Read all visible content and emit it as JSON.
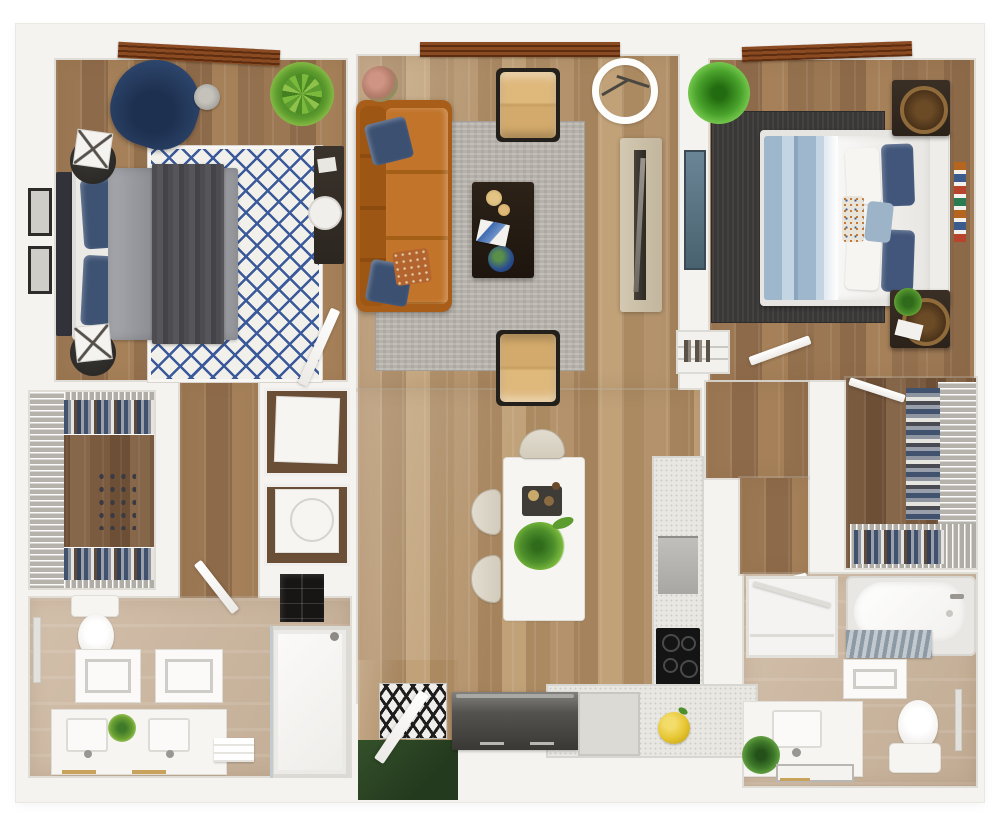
{
  "plan": {
    "label": "3D top-down floor plan of a two-bedroom, two-bathroom apartment with open living, dining and kitchen",
    "view": "3d-render-top-down",
    "canvas_width": "1000",
    "canvas_height": "818"
  },
  "palette": {
    "background": "#ffffff",
    "wall": "#f5f3f0",
    "wood_light": "#bb9c75",
    "wood_medium": "#a07b58",
    "wood_dark_closet": "#7e5f43",
    "bathroom_floor_tan": "#c9b299",
    "living_rug_gray": "#b6b1aa",
    "bedroom1_rug_blue": "#3b5a9b",
    "bedroom2_rug_charcoal": "#3a3836",
    "sofa_orange": "#b3661d",
    "armchair_tan": "#d4aa6c",
    "pillow_navy": "#3e5374",
    "bed2_sheet_blue": "#a9bed2",
    "plant_green": "#5d9c2e",
    "grass_green": "#2c421f",
    "lemon_yellow": "#e6c52f",
    "window_wood_brown": "#8a4a22",
    "counter_speckle": "#e9e7e2",
    "cooktop_black": "#141414"
  },
  "rooms": [
    {
      "id": "bedroom-1",
      "items": [
        "bed-gray-duvet-navy-pillows",
        "blue-diamond-rug",
        "navy-accent-chair",
        "round-side-table",
        "nightstand-lamp-top",
        "nightstand-lamp-bottom",
        "potted-plant",
        "desk-with-chair",
        "wall-frames",
        "wood-blind-window"
      ]
    },
    {
      "id": "living-room",
      "items": [
        "orange-leather-sofa",
        "gray-area-rug",
        "dark-coffee-table",
        "tan-armchair-top",
        "tan-armchair-bottom",
        "arc-floor-lamp",
        "media-console-tv",
        "flower-vase",
        "wood-frame-window"
      ]
    },
    {
      "id": "bedroom-2",
      "items": [
        "bed-white-duvet-blue-sheets",
        "charcoal-rug",
        "nightstand-ring-lamp-top",
        "nightstand-ring-lamp-bottom",
        "potted-plant",
        "wall-art-panel",
        "gallery-strip",
        "wood-blind-window"
      ]
    },
    {
      "id": "walk-in-closet-left",
      "items": [
        "wire-shelving",
        "hanging-clothes"
      ]
    },
    {
      "id": "laundry-closets",
      "items": [
        "dryer",
        "washer",
        "glass-front-cabinet"
      ]
    },
    {
      "id": "bathroom-1",
      "items": [
        "toilet",
        "double-sink-vanity",
        "bath-mat-left",
        "bath-mat-right",
        "walk-in-shower",
        "towel-bar",
        "folded-towels",
        "pineapple-plant"
      ]
    },
    {
      "id": "dining-kitchen",
      "items": [
        "white-island-table",
        "cream-chair-top",
        "cream-chair-left-1",
        "cream-chair-left-2",
        "island-plant",
        "serving-tray",
        "tall-counter-with-oven",
        "black-cooktop",
        "dark-lower-cabinet",
        "white-lower-cabinet",
        "lemon-bowl"
      ]
    },
    {
      "id": "entry",
      "items": [
        "geometric-doormat",
        "front-door-leaf",
        "grass-outside"
      ]
    },
    {
      "id": "hallways",
      "items": [
        "bedroom1-door",
        "bathroom1-door",
        "bedroom2-door",
        "bathroom2-door",
        "closet2-door"
      ]
    },
    {
      "id": "linen-closet",
      "items": [
        "shelves-with-items"
      ]
    },
    {
      "id": "walk-in-closet-right",
      "items": [
        "wire-shelving",
        "hanging-clothes"
      ]
    },
    {
      "id": "bathroom-2",
      "items": [
        "bathtub",
        "striped-glass-panel",
        "bath-mat",
        "toilet",
        "vanity-with-plant",
        "linen-niche",
        "towel-bar",
        "gold-trim-mat"
      ]
    }
  ]
}
